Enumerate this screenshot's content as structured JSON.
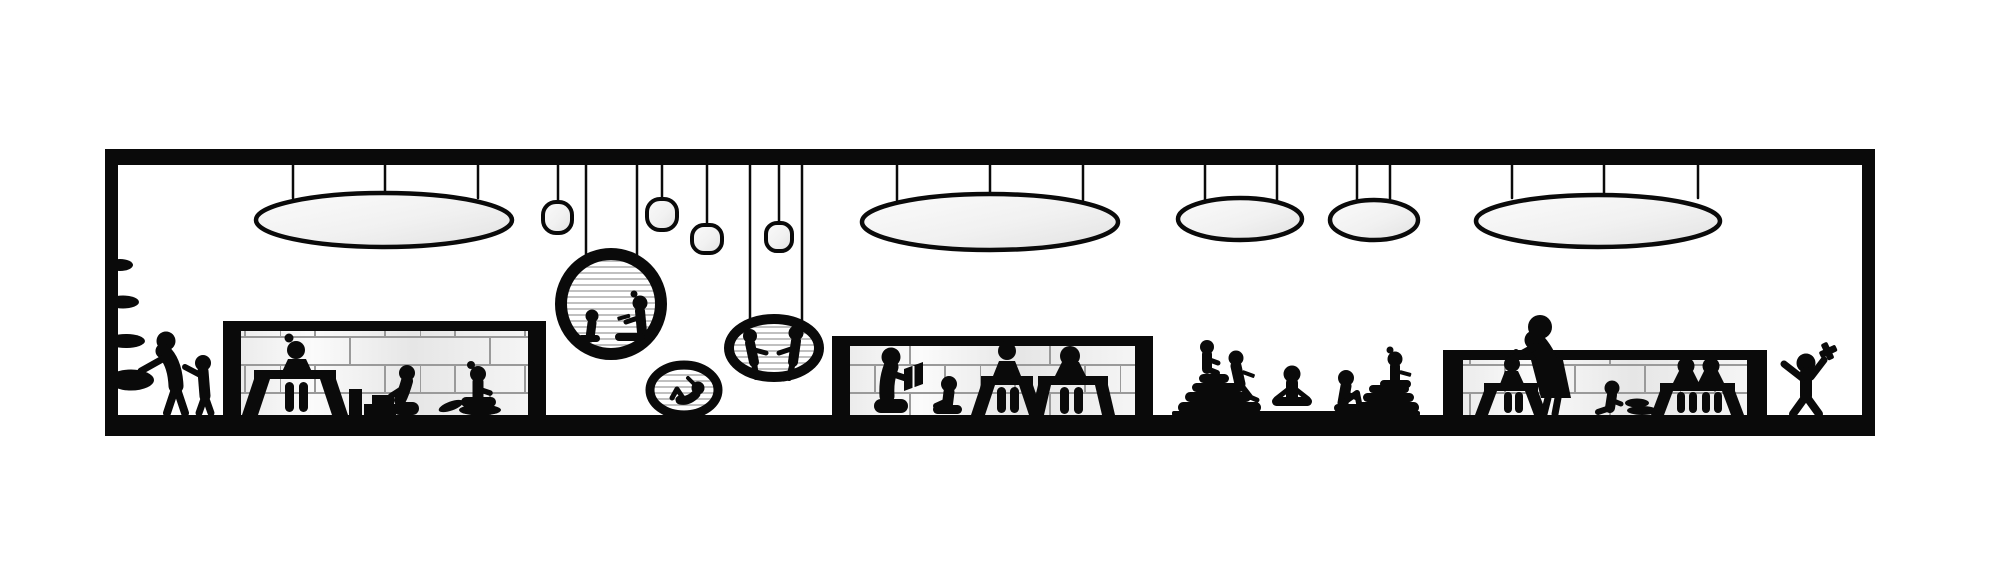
{
  "scene": {
    "type": "architectural-section-pictogram",
    "subject": "children's library / reading room section with silhouette figures",
    "room": {
      "outline": "thick black rectangular frame",
      "bounds": {
        "left": 105,
        "top": 149,
        "right": 1875,
        "bottom": 436
      },
      "wall_thickness": 13,
      "floor_thickness": 21
    }
  },
  "colors": {
    "ink": "#0a0a0a",
    "background": "#ffffff",
    "lamp_fill_light": "#fbfbfb",
    "lamp_fill_dark": "#e2e2e2",
    "brick_joint": "#9a9a9a",
    "pod_stripe": "#b0b0b0"
  },
  "ceiling_lamps": {
    "large_oval": [
      {
        "id": "L1",
        "cx": 384,
        "cy": 220,
        "rx": 128,
        "ry": 27,
        "cords": [
          293,
          385,
          478
        ]
      },
      {
        "id": "L2",
        "cx": 990,
        "cy": 222,
        "rx": 128,
        "ry": 28,
        "cords": [
          897,
          990,
          1083
        ]
      },
      {
        "id": "L3",
        "cx": 1240,
        "cy": 219,
        "rx": 62,
        "ry": 21,
        "cords": [
          1205,
          1277
        ]
      },
      {
        "id": "L4",
        "cx": 1374,
        "cy": 220,
        "rx": 44,
        "ry": 20,
        "cords": [
          1357,
          1390
        ]
      },
      {
        "id": "L5",
        "cx": 1598,
        "cy": 221,
        "rx": 122,
        "ry": 26,
        "cords": [
          1512,
          1604,
          1698
        ]
      }
    ],
    "small_round": [
      {
        "id": "S1",
        "x": 543,
        "y": 202,
        "w": 29,
        "h": 31,
        "cord": 558
      },
      {
        "id": "S2",
        "x": 647,
        "y": 199,
        "w": 30,
        "h": 31,
        "cord": 662
      },
      {
        "id": "S3",
        "x": 692,
        "y": 225,
        "w": 30,
        "h": 28,
        "cord": 707
      },
      {
        "id": "S4",
        "x": 766,
        "y": 223,
        "w": 26,
        "h": 28,
        "cord": 779
      }
    ]
  },
  "hanging_pods": [
    {
      "id": "pod-large",
      "cx": 611,
      "cy": 304,
      "rx": 50,
      "ry": 50,
      "cords": [
        586,
        637
      ],
      "occupants": [
        "child sitting knees up",
        "adult with bun reading"
      ]
    },
    {
      "id": "pod-medium",
      "cx": 774,
      "cy": 348,
      "rx": 45,
      "ry": 29,
      "cords": [
        750,
        802
      ],
      "occupants": [
        "two people seated facing each other, legs dangling"
      ]
    },
    {
      "id": "pod-small",
      "cx": 684,
      "cy": 390,
      "rx": 34,
      "ry": 25,
      "cords": [],
      "occupants": [
        "person reclining with knees up"
      ]
    }
  ],
  "desk_units": [
    {
      "id": "unit-1",
      "frame": {
        "x1": 223,
        "x2": 546,
        "top": 321
      },
      "occupants": [
        "woman with bun seated at splay-leg desk",
        "child kneeling at block tower and steps",
        "child with bun on floor cushions"
      ]
    },
    {
      "id": "unit-2",
      "frame": {
        "x1": 832,
        "x2": 1153,
        "top": 336
      },
      "occupants": [
        "adult kneeling reading open book",
        "child seated hugging knees",
        "child with topknot at desk",
        "adult at desk"
      ]
    },
    {
      "id": "unit-3",
      "frame": {
        "x1": 1443,
        "x2": 1767,
        "top": 350
      },
      "occupants": [
        "child at desk",
        "standing woman leaning over desk",
        "small child on floor with cushions",
        "two people side by side at desk"
      ]
    }
  ],
  "left_wall": {
    "shelves": [
      {
        "y": 265,
        "rx": 12
      },
      {
        "y": 302,
        "rx": 15
      },
      {
        "y": 341,
        "rx": 18
      },
      {
        "y": 380,
        "rx": 22
      }
    ],
    "figures": [
      "adult bending to reach bottom pouf",
      "child pointing at adult"
    ]
  },
  "floor_cushion_area": {
    "mat": {
      "x1": 1172,
      "x2": 1420,
      "y": 411
    },
    "cushion_pyramids": [
      {
        "x": 1178,
        "layers": 4,
        "children_on_top": 2
      },
      {
        "x": 1357,
        "layers": 3,
        "children_on_top": 1
      }
    ],
    "children_on_mat": [
      "child meditating cross-legged",
      "child sitting with knees up"
    ]
  },
  "right_area": {
    "figure": "child cheering with arms raised holding toy hammer"
  },
  "people_count": 25
}
